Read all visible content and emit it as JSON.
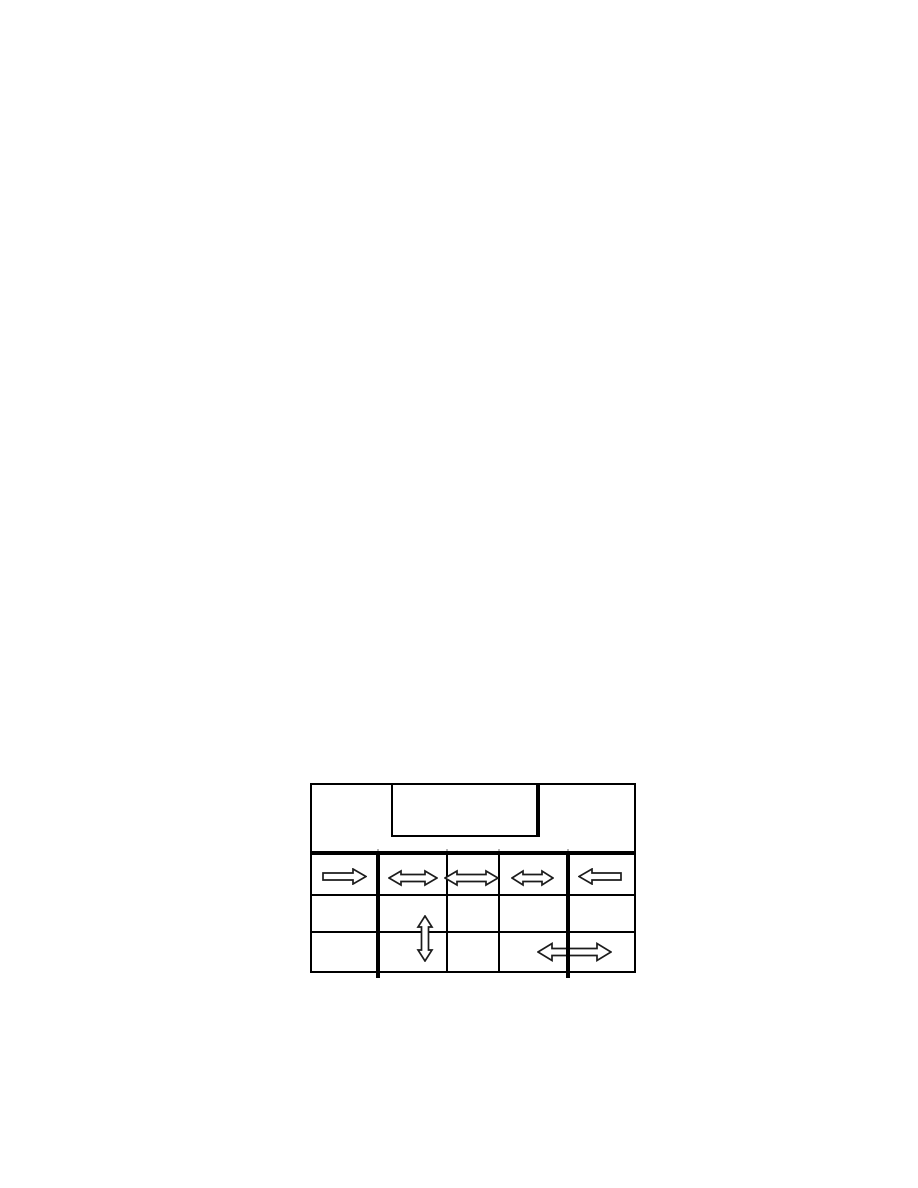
{
  "page": {
    "background_color": "#ffffff",
    "content": "blank document page with a single untitled figure near the bottom"
  },
  "figure": {
    "type": "panel-diagram",
    "description": "Front-panel layout: top panel with an inset rectangular window (thick right edge), above a grid of 5 columns by 3 rows; open block arrows mark movement directions",
    "line_color": "#000000",
    "thick_divider_color": "#000000",
    "arrow_fill_color": "#ffffff",
    "arrow_stroke_color": "#1c1c1c",
    "grid": {
      "columns": 5,
      "rows": 3,
      "thick_vertical_dividers_after_columns": [
        1,
        4
      ]
    },
    "arrows": [
      {
        "id": "row1-col1",
        "direction": "right"
      },
      {
        "id": "row1-col2",
        "direction": "left-right"
      },
      {
        "id": "row1-col3",
        "direction": "left-right"
      },
      {
        "id": "row1-col4",
        "direction": "left-right"
      },
      {
        "id": "row1-col5",
        "direction": "left"
      },
      {
        "id": "col2-rows2-3",
        "direction": "up-down"
      },
      {
        "id": "row3-cols4-5",
        "direction": "left-right"
      }
    ]
  }
}
